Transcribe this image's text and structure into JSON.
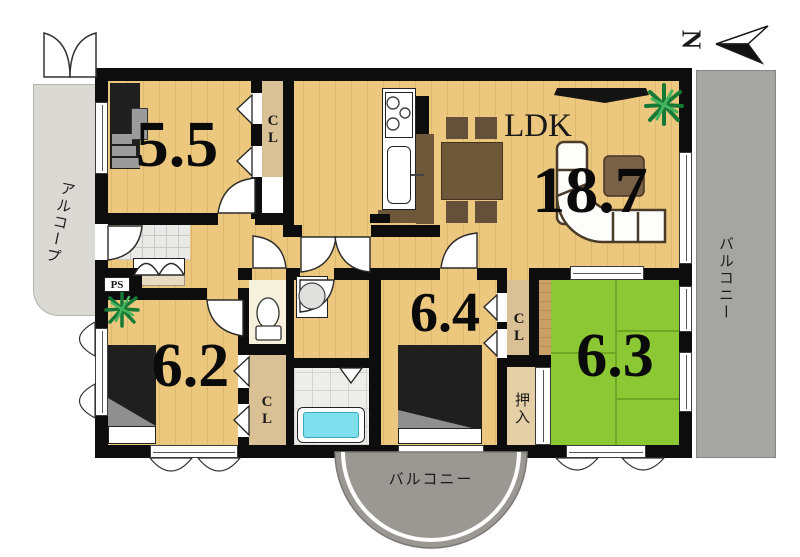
{
  "compass": {
    "north_label": "N"
  },
  "rooms": {
    "bedroom_5_5": {
      "size": "5.5"
    },
    "ldk": {
      "label": "LDK",
      "size": "18.7"
    },
    "bedroom_6_2": {
      "size": "6.2"
    },
    "bedroom_6_4": {
      "size": "6.4"
    },
    "tatami_6_3": {
      "size": "6.3"
    }
  },
  "storage": {
    "closet_5_5": "CL",
    "closet_6_2": "CL",
    "closet_6_4": "CL",
    "oshiire": "押入",
    "pipe_space": "PS"
  },
  "exterior": {
    "alcove": "アルコープ",
    "balcony_right": "バルコニー",
    "balcony_bottom": "バルコニー"
  },
  "colors": {
    "wood": "#ecc87e",
    "tatami_green": "#8cc834",
    "balcony_gray": "#a5a5a3",
    "wall_black": "#0d0d0d",
    "bathtub_cyan": "#7ee0ec"
  }
}
